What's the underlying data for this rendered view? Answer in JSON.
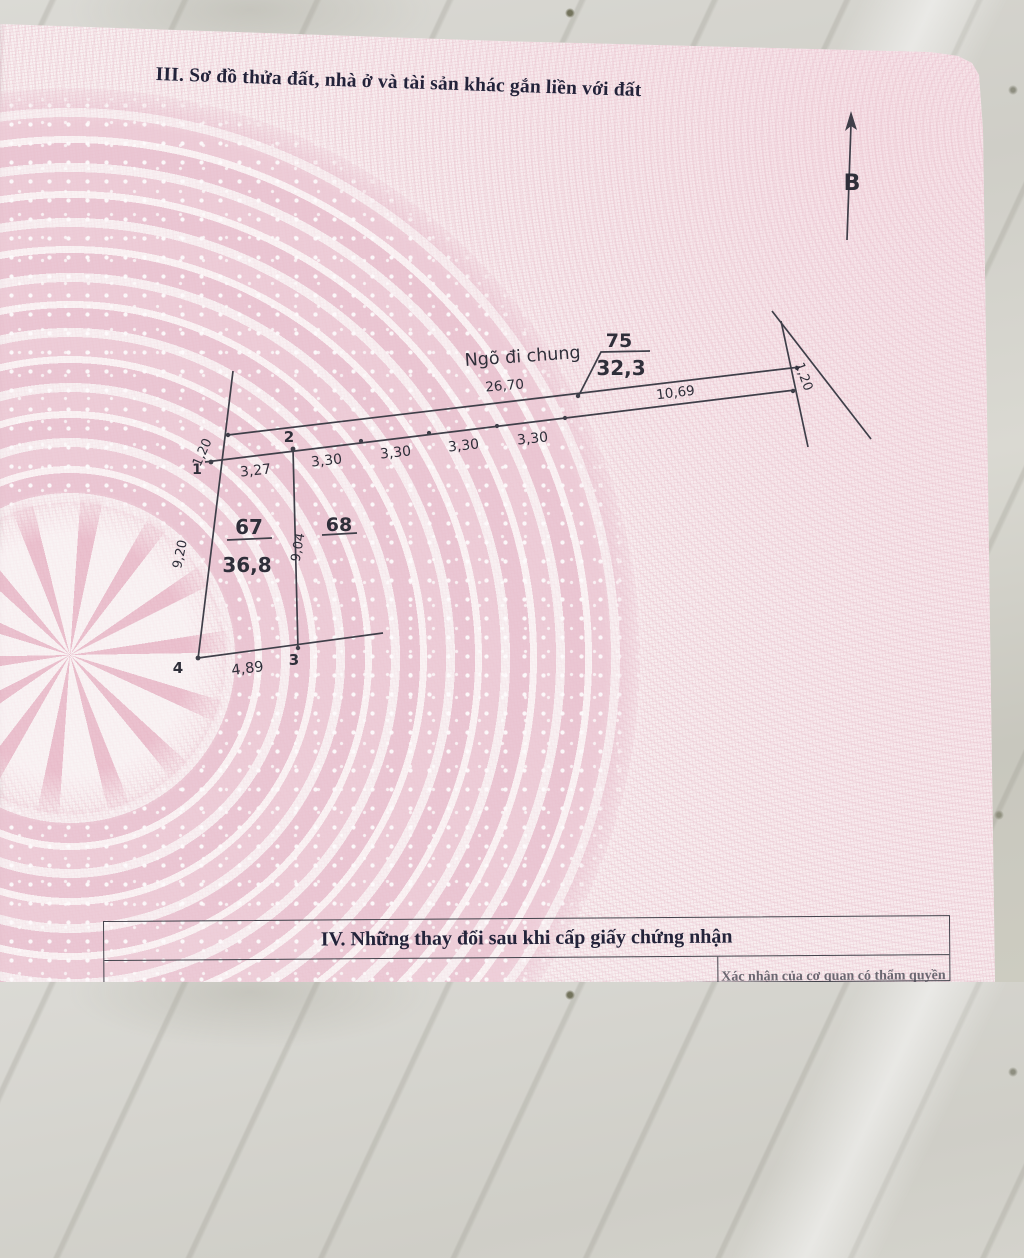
{
  "document": {
    "section3_title": "III. Sơ đồ thửa đất, nhà ở và tài sản khác gắn liền với đất",
    "section4": {
      "title": "IV. Những thay đổi sau khi cấp giấy chứng nhận",
      "right_column_header": "Xác nhận của cơ quan có thẩm quyền"
    }
  },
  "compass": {
    "north_label": "B"
  },
  "diagram": {
    "alley_label": "Ngõ đi chung",
    "alley_parcel_number": "75",
    "alley_parcel_area": "32,3",
    "top_edge_left_length": "26,70",
    "top_edge_right_length": "10,69",
    "alley_width_left": "1,20",
    "alley_width_right": "1,20",
    "front_segments": [
      "3,27",
      "3,30",
      "3,30",
      "3,30",
      "3,30"
    ],
    "corner_points": [
      "1",
      "2",
      "3",
      "4"
    ],
    "left_edge_length": "9,20",
    "middle_edge_length": "9,04",
    "bottom_edge_length": "4,89",
    "parcel67_number": "67",
    "parcel67_area": "36,8",
    "parcel68_number": "68"
  },
  "colors": {
    "paper_pink": "#ecc8d4",
    "print_ink": "#34343e",
    "marble": "#d3d2cb"
  }
}
